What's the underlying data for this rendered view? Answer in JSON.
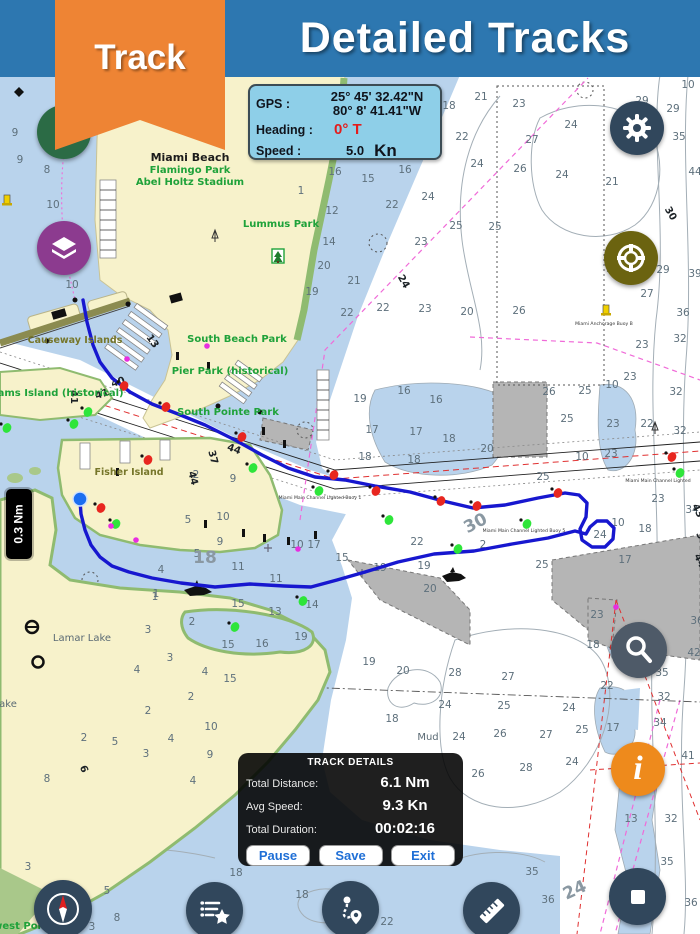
{
  "colors": {
    "header_blue": "#2d77b0",
    "ribbon_orange": "#ee8434",
    "gps_box": "#8ecfe8",
    "heading_red": "#e31c1c",
    "track_blue": "#1717cf",
    "water_shallow": "#b9d3ec",
    "water_deep": "#ffffff",
    "land_yellow": "#f7f2cb",
    "shore_green": "#8fbb70",
    "panel_button_text": "#1f6fd6",
    "buoy_red": "#e8261f",
    "buoy_green": "#2ee53a",
    "buoy_magenta": "#e82ee0",
    "spoil_gray": "#b5b5b5"
  },
  "header": {
    "title": "Detailed Tracks",
    "ribbon_label": "Track"
  },
  "gps_panel": {
    "gps_label": "GPS :",
    "lat": "25° 45' 32.42\"N",
    "lon": "80° 8' 41.41\"W",
    "heading_label": "Heading :",
    "heading_value": "0° T",
    "speed_label": "Speed :",
    "speed_value": "5.0",
    "speed_unit": "Kn"
  },
  "scale_indicator": "0.3 Nm",
  "track_panel": {
    "title": "TRACK DETAILS",
    "distance_label": "Total Distance:",
    "distance_value": "6.1 Nm",
    "avg_speed_label": "Avg Speed:",
    "avg_speed_value": "9.3  Kn",
    "duration_label": "Total Duration:",
    "duration_value": "00:02:16",
    "pause_label": "Pause",
    "save_label": "Save",
    "exit_label": "Exit"
  },
  "buttons": {
    "layers": "layers-icon",
    "settings": "gear-icon",
    "mob": "life-ring-icon",
    "search": "magnifier-icon",
    "info": "info-icon",
    "compass": "compass-icon",
    "tracklist": "list-star-icon",
    "routes": "route-pin-icon",
    "measure": "ruler-icon",
    "stop": "stop-square-icon"
  },
  "map": {
    "place_labels": [
      {
        "t": "Miami Beach",
        "x": 190,
        "y": 161,
        "s": "black"
      },
      {
        "t": "Flamingo Park",
        "x": 190,
        "y": 173,
        "s": "green"
      },
      {
        "t": "Abel Holtz Stadium",
        "x": 190,
        "y": 185,
        "s": "green"
      },
      {
        "t": "Lummus Park",
        "x": 281,
        "y": 227,
        "s": "green"
      },
      {
        "t": "South Beach Park",
        "x": 237,
        "y": 342,
        "s": "green"
      },
      {
        "t": "Pier Park (historical)",
        "x": 230,
        "y": 374,
        "s": "green"
      },
      {
        "t": "South Pointe Park",
        "x": 228,
        "y": 415,
        "s": "green"
      },
      {
        "t": "Sams Island (historical)",
        "x": 57,
        "y": 396,
        "s": "green"
      },
      {
        "t": "Causeway Islands",
        "x": 75,
        "y": 343,
        "s": "olive"
      },
      {
        "t": "Fisher Island",
        "x": 129,
        "y": 475,
        "s": "olive"
      },
      {
        "t": "Lamar Lake",
        "x": 82,
        "y": 641,
        "s": "gray"
      },
      {
        "t": "ake",
        "x": 8,
        "y": 707,
        "s": "gray"
      },
      {
        "t": "Mud",
        "x": 428,
        "y": 740,
        "s": "gray"
      },
      {
        "t": "west Point",
        "x": 23,
        "y": 929,
        "s": "green"
      },
      {
        "t": "Miami Anchorage Buoy B",
        "x": 604,
        "y": 325,
        "s": "tiny"
      },
      {
        "t": "Miami Main Channel Lighted Buoy 1",
        "x": 320,
        "y": 499,
        "s": "tiny"
      },
      {
        "t": "Miami Main Channel Lighted Buoy 5",
        "x": 524,
        "y": 532,
        "s": "tiny"
      },
      {
        "t": "Miami Main Channel Lighted",
        "x": 658,
        "y": 482,
        "s": "tiny"
      }
    ],
    "depths": [
      [
        15,
        136,
        "9"
      ],
      [
        20,
        163,
        "9"
      ],
      [
        47,
        173,
        "8"
      ],
      [
        53,
        208,
        "10"
      ],
      [
        72,
        288,
        "10"
      ],
      [
        449,
        109,
        "18"
      ],
      [
        481,
        100,
        "21"
      ],
      [
        519,
        107,
        "23"
      ],
      [
        462,
        140,
        "22"
      ],
      [
        571,
        128,
        "24"
      ],
      [
        532,
        143,
        "27"
      ],
      [
        477,
        167,
        "24"
      ],
      [
        520,
        172,
        "26"
      ],
      [
        562,
        178,
        "24"
      ],
      [
        612,
        185,
        "21"
      ],
      [
        642,
        104,
        "29"
      ],
      [
        673,
        112,
        "29"
      ],
      [
        679,
        140,
        "35"
      ],
      [
        688,
        88,
        "10"
      ],
      [
        695,
        175,
        "44"
      ],
      [
        663,
        273,
        "29"
      ],
      [
        695,
        277,
        "39"
      ],
      [
        617,
        256,
        "23"
      ],
      [
        613,
        272,
        "25"
      ],
      [
        335,
        175,
        "16"
      ],
      [
        368,
        182,
        "15"
      ],
      [
        405,
        173,
        "16"
      ],
      [
        301,
        194,
        "1"
      ],
      [
        332,
        214,
        "12"
      ],
      [
        392,
        208,
        "22"
      ],
      [
        428,
        200,
        "24"
      ],
      [
        329,
        245,
        "14"
      ],
      [
        421,
        245,
        "23"
      ],
      [
        456,
        229,
        "25"
      ],
      [
        495,
        230,
        "25"
      ],
      [
        324,
        269,
        "20"
      ],
      [
        354,
        284,
        "21"
      ],
      [
        312,
        295,
        "19"
      ],
      [
        425,
        312,
        "23"
      ],
      [
        347,
        316,
        "22"
      ],
      [
        383,
        311,
        "22"
      ],
      [
        467,
        315,
        "20"
      ],
      [
        519,
        314,
        "26"
      ],
      [
        647,
        297,
        "27"
      ],
      [
        683,
        316,
        "36"
      ],
      [
        680,
        342,
        "32"
      ],
      [
        642,
        348,
        "23"
      ],
      [
        549,
        395,
        "26"
      ],
      [
        585,
        394,
        "25"
      ],
      [
        612,
        388,
        "10"
      ],
      [
        630,
        380,
        "23"
      ],
      [
        567,
        422,
        "25"
      ],
      [
        613,
        427,
        "23"
      ],
      [
        647,
        427,
        "22"
      ],
      [
        676,
        395,
        "32"
      ],
      [
        680,
        434,
        "32"
      ],
      [
        360,
        402,
        "19"
      ],
      [
        404,
        394,
        "16"
      ],
      [
        436,
        403,
        "16"
      ],
      [
        372,
        433,
        "17"
      ],
      [
        416,
        435,
        "17"
      ],
      [
        449,
        442,
        "18"
      ],
      [
        365,
        460,
        "18"
      ],
      [
        414,
        463,
        "18"
      ],
      [
        487,
        452,
        "20"
      ],
      [
        543,
        480,
        "25"
      ],
      [
        582,
        460,
        "10"
      ],
      [
        611,
        457,
        "23"
      ],
      [
        600,
        538,
        "24"
      ],
      [
        618,
        526,
        "10"
      ],
      [
        658,
        502,
        "23"
      ],
      [
        692,
        513,
        "34"
      ],
      [
        645,
        532,
        "18"
      ],
      [
        625,
        563,
        "17"
      ],
      [
        542,
        568,
        "25"
      ],
      [
        483,
        548,
        "2"
      ],
      [
        197,
        557,
        "5"
      ],
      [
        161,
        573,
        "4"
      ],
      [
        155,
        600,
        "1"
      ],
      [
        192,
        625,
        "2"
      ],
      [
        238,
        570,
        "11"
      ],
      [
        276,
        582,
        "11"
      ],
      [
        238,
        607,
        "15"
      ],
      [
        275,
        615,
        "13"
      ],
      [
        312,
        608,
        "14"
      ],
      [
        262,
        647,
        "16"
      ],
      [
        228,
        648,
        "15"
      ],
      [
        301,
        640,
        "19"
      ],
      [
        342,
        561,
        "15"
      ],
      [
        380,
        571,
        "19"
      ],
      [
        424,
        569,
        "19"
      ],
      [
        417,
        545,
        "22"
      ],
      [
        430,
        592,
        "20"
      ],
      [
        455,
        676,
        "28"
      ],
      [
        403,
        674,
        "20"
      ],
      [
        369,
        665,
        "19"
      ],
      [
        230,
        682,
        "15"
      ],
      [
        170,
        661,
        "3"
      ],
      [
        205,
        675,
        "4"
      ],
      [
        297,
        548,
        "10"
      ],
      [
        314,
        548,
        "17"
      ],
      [
        156,
        597,
        "1"
      ],
      [
        148,
        633,
        "3"
      ],
      [
        137,
        673,
        "4"
      ],
      [
        191,
        700,
        "2"
      ],
      [
        148,
        714,
        "2"
      ],
      [
        115,
        745,
        "5"
      ],
      [
        84,
        741,
        "2"
      ],
      [
        146,
        757,
        "3"
      ],
      [
        171,
        742,
        "4"
      ],
      [
        211,
        730,
        "10"
      ],
      [
        210,
        758,
        "9"
      ],
      [
        47,
        782,
        "8"
      ],
      [
        193,
        784,
        "4"
      ],
      [
        445,
        708,
        "24"
      ],
      [
        504,
        709,
        "25"
      ],
      [
        569,
        711,
        "24"
      ],
      [
        500,
        737,
        "26"
      ],
      [
        546,
        738,
        "27"
      ],
      [
        582,
        733,
        "25"
      ],
      [
        459,
        740,
        "24"
      ],
      [
        526,
        771,
        "28"
      ],
      [
        478,
        777,
        "26"
      ],
      [
        572,
        765,
        "24"
      ],
      [
        392,
        722,
        "18"
      ],
      [
        607,
        689,
        "22"
      ],
      [
        508,
        680,
        "27"
      ],
      [
        631,
        822,
        "13"
      ],
      [
        671,
        822,
        "32"
      ],
      [
        667,
        865,
        "35"
      ],
      [
        691,
        906,
        "36"
      ],
      [
        597,
        618,
        "23"
      ],
      [
        593,
        648,
        "18"
      ],
      [
        613,
        731,
        "17"
      ],
      [
        662,
        676,
        "35"
      ],
      [
        664,
        700,
        "32"
      ],
      [
        660,
        726,
        "34"
      ],
      [
        688,
        759,
        "41"
      ],
      [
        694,
        656,
        "42"
      ],
      [
        697,
        624,
        "36"
      ],
      [
        28,
        870,
        "3"
      ],
      [
        107,
        894,
        "5"
      ],
      [
        70,
        904,
        "2"
      ],
      [
        117,
        921,
        "8"
      ],
      [
        92,
        930,
        "3"
      ],
      [
        236,
        876,
        "18"
      ],
      [
        209,
        908,
        "17"
      ],
      [
        302,
        898,
        "18"
      ],
      [
        349,
        899,
        "23"
      ],
      [
        387,
        925,
        "22"
      ],
      [
        532,
        875,
        "35"
      ],
      [
        548,
        903,
        "36"
      ],
      [
        196,
        478,
        "2"
      ],
      [
        233,
        482,
        "9"
      ],
      [
        188,
        523,
        "5"
      ],
      [
        223,
        520,
        "10"
      ],
      [
        220,
        545,
        "9"
      ]
    ],
    "channel_numbers": [
      [
        119,
        385,
        "40",
        -18,
        0
      ],
      [
        103,
        397,
        "41",
        -18,
        0
      ],
      [
        71,
        397,
        "41",
        90,
        0
      ],
      [
        233,
        452,
        "44",
        20,
        0
      ],
      [
        210,
        458,
        "37",
        75,
        0
      ],
      [
        190,
        479,
        "44",
        75,
        0
      ],
      [
        478,
        528,
        "30",
        -28,
        1
      ],
      [
        205,
        563,
        "18",
        0,
        1
      ],
      [
        577,
        895,
        "24",
        -25,
        1
      ],
      [
        695,
        512,
        "43",
        65,
        0
      ],
      [
        699,
        540,
        "37",
        65,
        0
      ],
      [
        697,
        562,
        "44",
        65,
        0
      ],
      [
        668,
        215,
        "30",
        60,
        0
      ],
      [
        150,
        343,
        "13",
        55,
        0
      ],
      [
        401,
        283,
        "24",
        60,
        0
      ],
      [
        81,
        770,
        "6",
        70,
        0
      ]
    ],
    "buoys": {
      "red": [
        [
          124,
          386
        ],
        [
          166,
          407
        ],
        [
          242,
          437
        ],
        [
          334,
          475
        ],
        [
          376,
          491
        ],
        [
          441,
          501
        ],
        [
          477,
          506
        ],
        [
          558,
          493
        ],
        [
          672,
          457
        ],
        [
          148,
          460
        ],
        [
          101,
          508
        ]
      ],
      "green": [
        [
          88,
          412
        ],
        [
          74,
          424
        ],
        [
          7,
          428
        ],
        [
          116,
          524
        ],
        [
          253,
          468
        ],
        [
          319,
          491
        ],
        [
          389,
          520
        ],
        [
          458,
          549
        ],
        [
          527,
          524
        ],
        [
          680,
          473
        ],
        [
          303,
          601
        ],
        [
          235,
          627
        ]
      ],
      "magenta": [
        [
          127,
          359
        ],
        [
          207,
          346
        ],
        [
          616,
          607
        ],
        [
          111,
          526
        ],
        [
          136,
          540
        ],
        [
          298,
          549
        ]
      ],
      "yellow": [
        [
          7,
          200
        ],
        [
          606,
          310
        ]
      ]
    },
    "track": {
      "color": "#1717cf",
      "points": [
        [
          83,
          300
        ],
        [
          87,
          322
        ],
        [
          93,
          345
        ],
        [
          100,
          362
        ],
        [
          112,
          378
        ],
        [
          130,
          392
        ],
        [
          152,
          404
        ],
        [
          178,
          414
        ],
        [
          205,
          425
        ],
        [
          235,
          440
        ],
        [
          262,
          455
        ],
        [
          288,
          468
        ],
        [
          315,
          477
        ],
        [
          345,
          480
        ],
        [
          375,
          486
        ],
        [
          410,
          492
        ],
        [
          443,
          501
        ],
        [
          473,
          508
        ],
        [
          505,
          505
        ],
        [
          538,
          498
        ],
        [
          565,
          493
        ],
        [
          579,
          495
        ],
        [
          587,
          503
        ],
        [
          586,
          517
        ],
        [
          580,
          529
        ],
        [
          582,
          540
        ],
        [
          592,
          547
        ],
        [
          605,
          547
        ],
        [
          613,
          539
        ],
        [
          614,
          528
        ],
        [
          607,
          521
        ],
        [
          597,
          521
        ],
        [
          590,
          527
        ],
        [
          586,
          534
        ],
        [
          575,
          531
        ],
        [
          548,
          538
        ],
        [
          512,
          544
        ],
        [
          474,
          551
        ],
        [
          434,
          554
        ],
        [
          398,
          562
        ],
        [
          365,
          572
        ],
        [
          337,
          580
        ],
        [
          311,
          587
        ],
        [
          284,
          586
        ],
        [
          250,
          584
        ],
        [
          215,
          587
        ],
        [
          181,
          583
        ],
        [
          152,
          578
        ],
        [
          129,
          572
        ],
        [
          112,
          566
        ],
        [
          100,
          557
        ],
        [
          91,
          545
        ],
        [
          85,
          530
        ],
        [
          81,
          514
        ],
        [
          80,
          501
        ]
      ],
      "position_marker": [
        80,
        499
      ]
    }
  }
}
